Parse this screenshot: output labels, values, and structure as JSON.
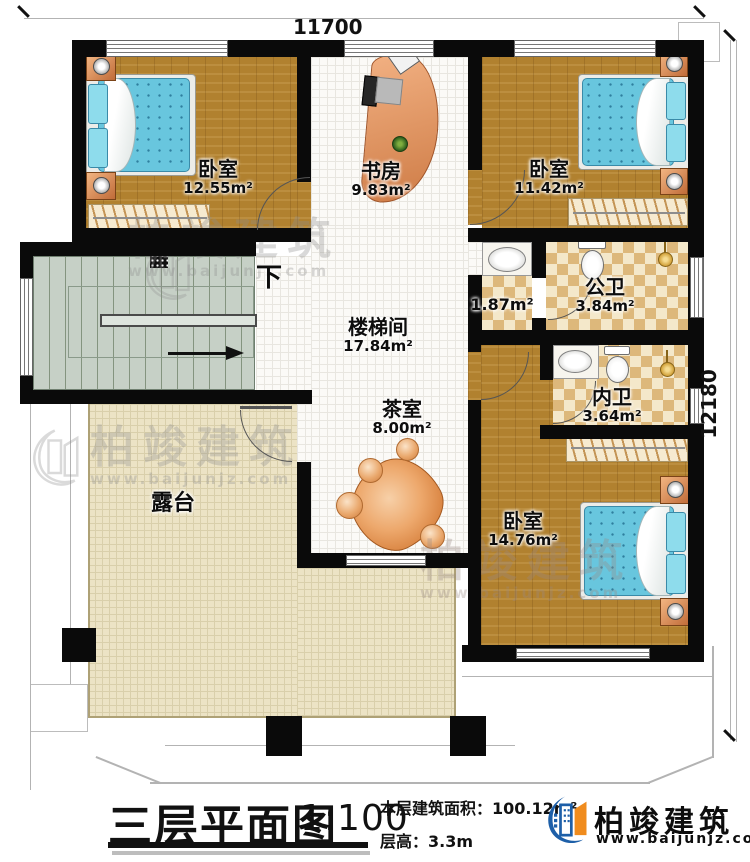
{
  "dimensions": {
    "top": "11700",
    "right": "12180"
  },
  "rooms": {
    "bedroom1": {
      "name": "卧室",
      "area": "12.55m²"
    },
    "study": {
      "name": "书房",
      "area": "9.83m²"
    },
    "bedroom2": {
      "name": "卧室",
      "area": "11.42m²"
    },
    "washroom": {
      "area": "1.87m²"
    },
    "public_bath": {
      "name": "公卫",
      "area": "3.84m²"
    },
    "stairwell": {
      "name": "楼梯间",
      "area": "17.84m²"
    },
    "ensuite_bath": {
      "name": "内卫",
      "area": "3.64m²"
    },
    "tea_room": {
      "name": "茶室",
      "area": "8.00m²"
    },
    "bedroom3": {
      "name": "卧室",
      "area": "14.76m²"
    },
    "terrace": {
      "name": "露台"
    }
  },
  "stairs": {
    "direction_label": "下"
  },
  "title_block": {
    "title": "三层平面图",
    "scale": "1:100",
    "area_label": "本层建筑面积：",
    "area_value": "100.12m²",
    "height_label": "层高：",
    "height_value": "3.3m"
  },
  "branding": {
    "company": "柏竣建筑",
    "website": "www.baijunjz.com"
  },
  "watermark": {
    "text": "柏竣建筑",
    "sub": "www.baijunjz.com"
  }
}
